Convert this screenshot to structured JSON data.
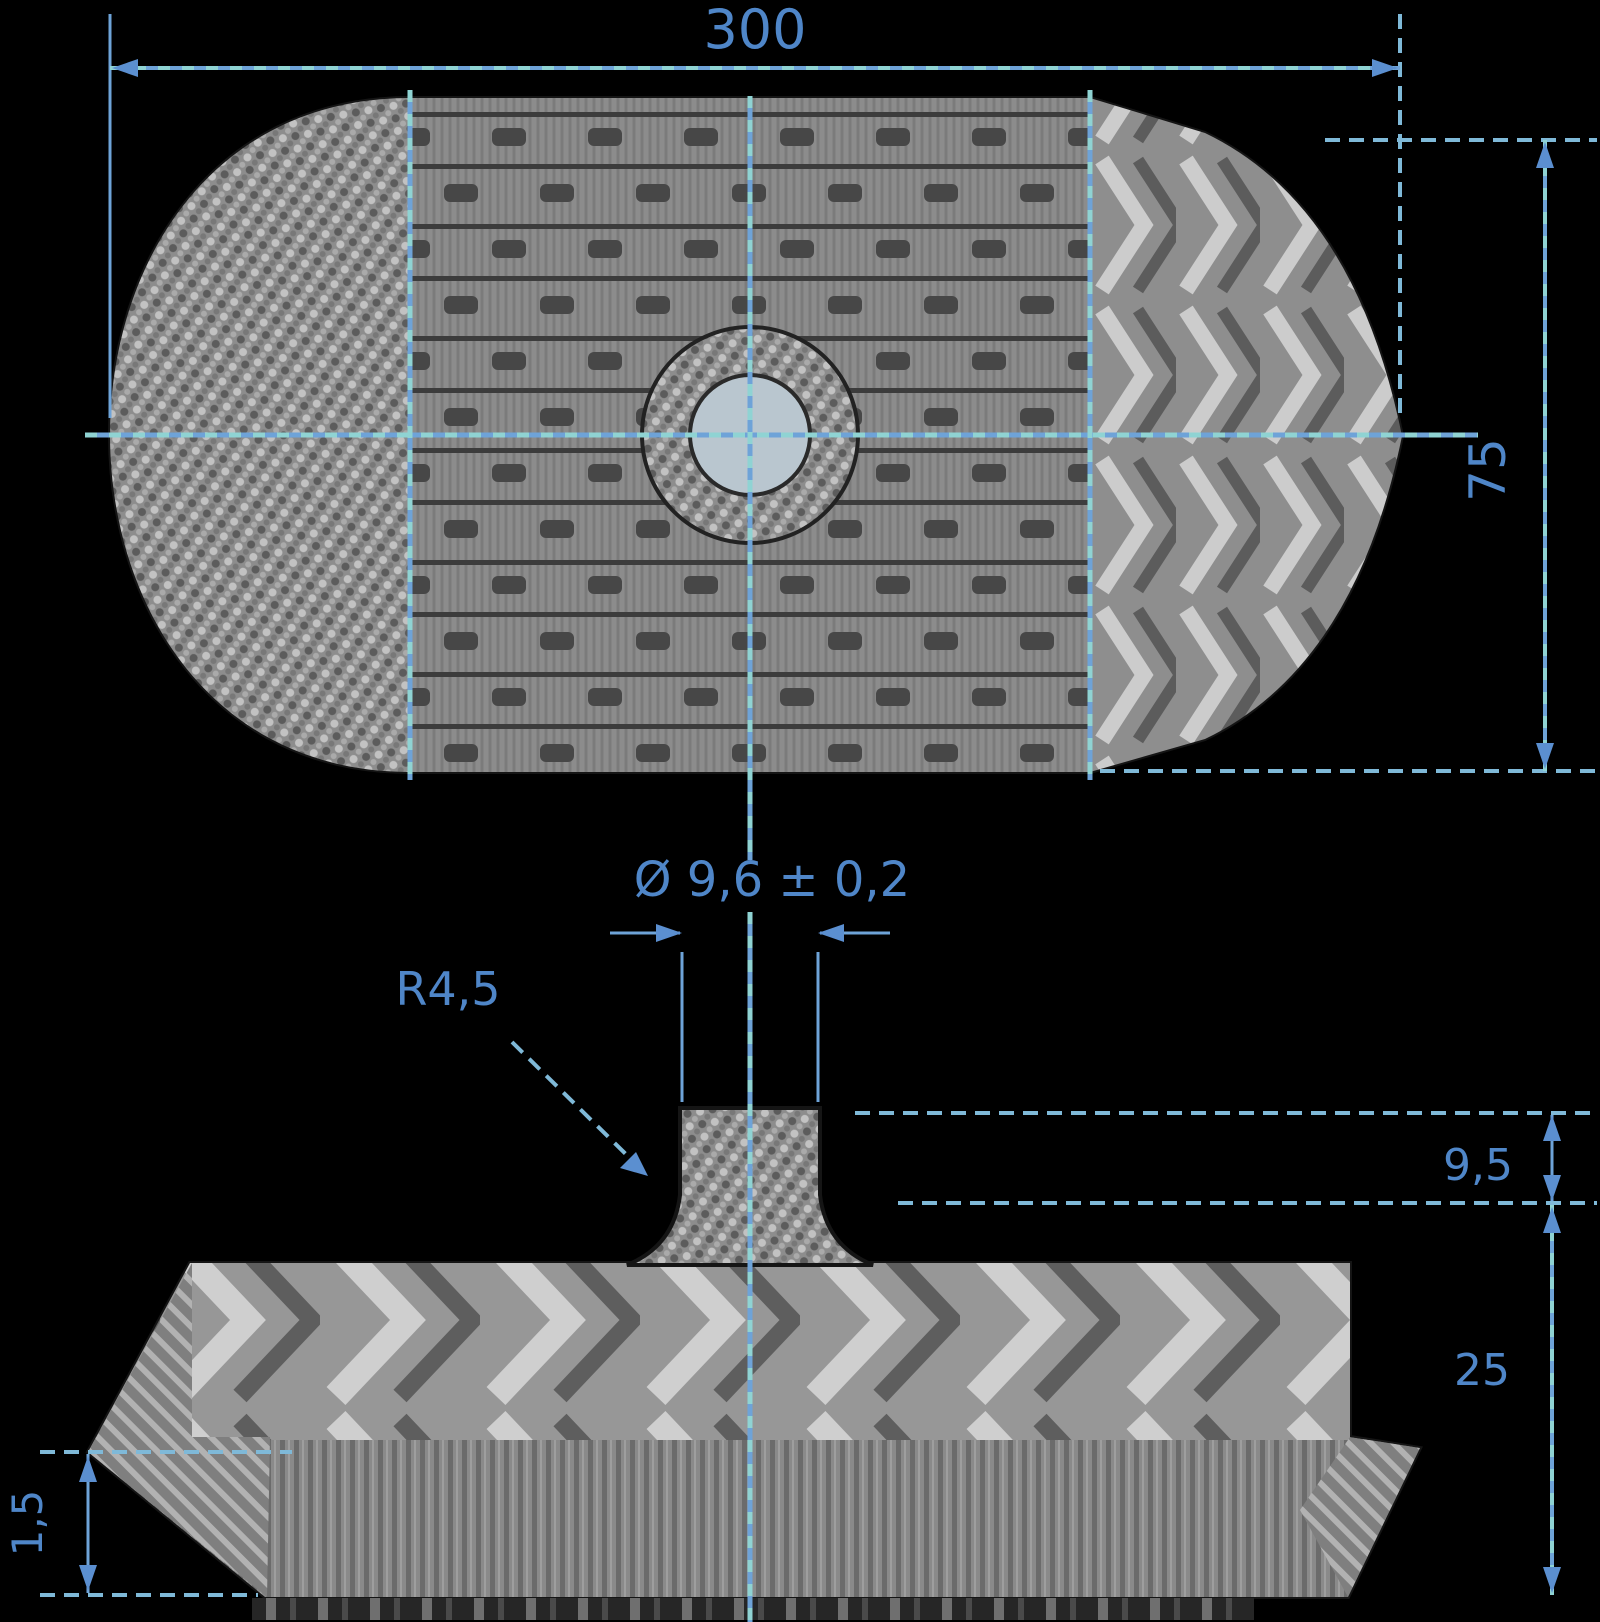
{
  "drawing": {
    "background": "#000000",
    "colors": {
      "dimension_blue": "#6ea3d8",
      "dimension_teal": "#8fd3d3",
      "label_blue": "#4f86c8",
      "part_grey": "#8f8f8f",
      "outline_dark": "#151515",
      "hub_bore_fill": "#b9c6cf"
    },
    "icons": {
      "arrowhead": "filled-triangle",
      "centerline": "dash-dot-blue-teal"
    },
    "top_view": {
      "dim_overall_length": "300",
      "dim_overall_width": "75"
    },
    "side_view": {
      "dim_stud_diameter": "Ø 9,6 ± 0,2",
      "leader_fillet_radius": "R4,5",
      "dim_stud_height": "9,5",
      "dim_base_height": "25",
      "dim_tip_thickness": "1,5"
    }
  }
}
